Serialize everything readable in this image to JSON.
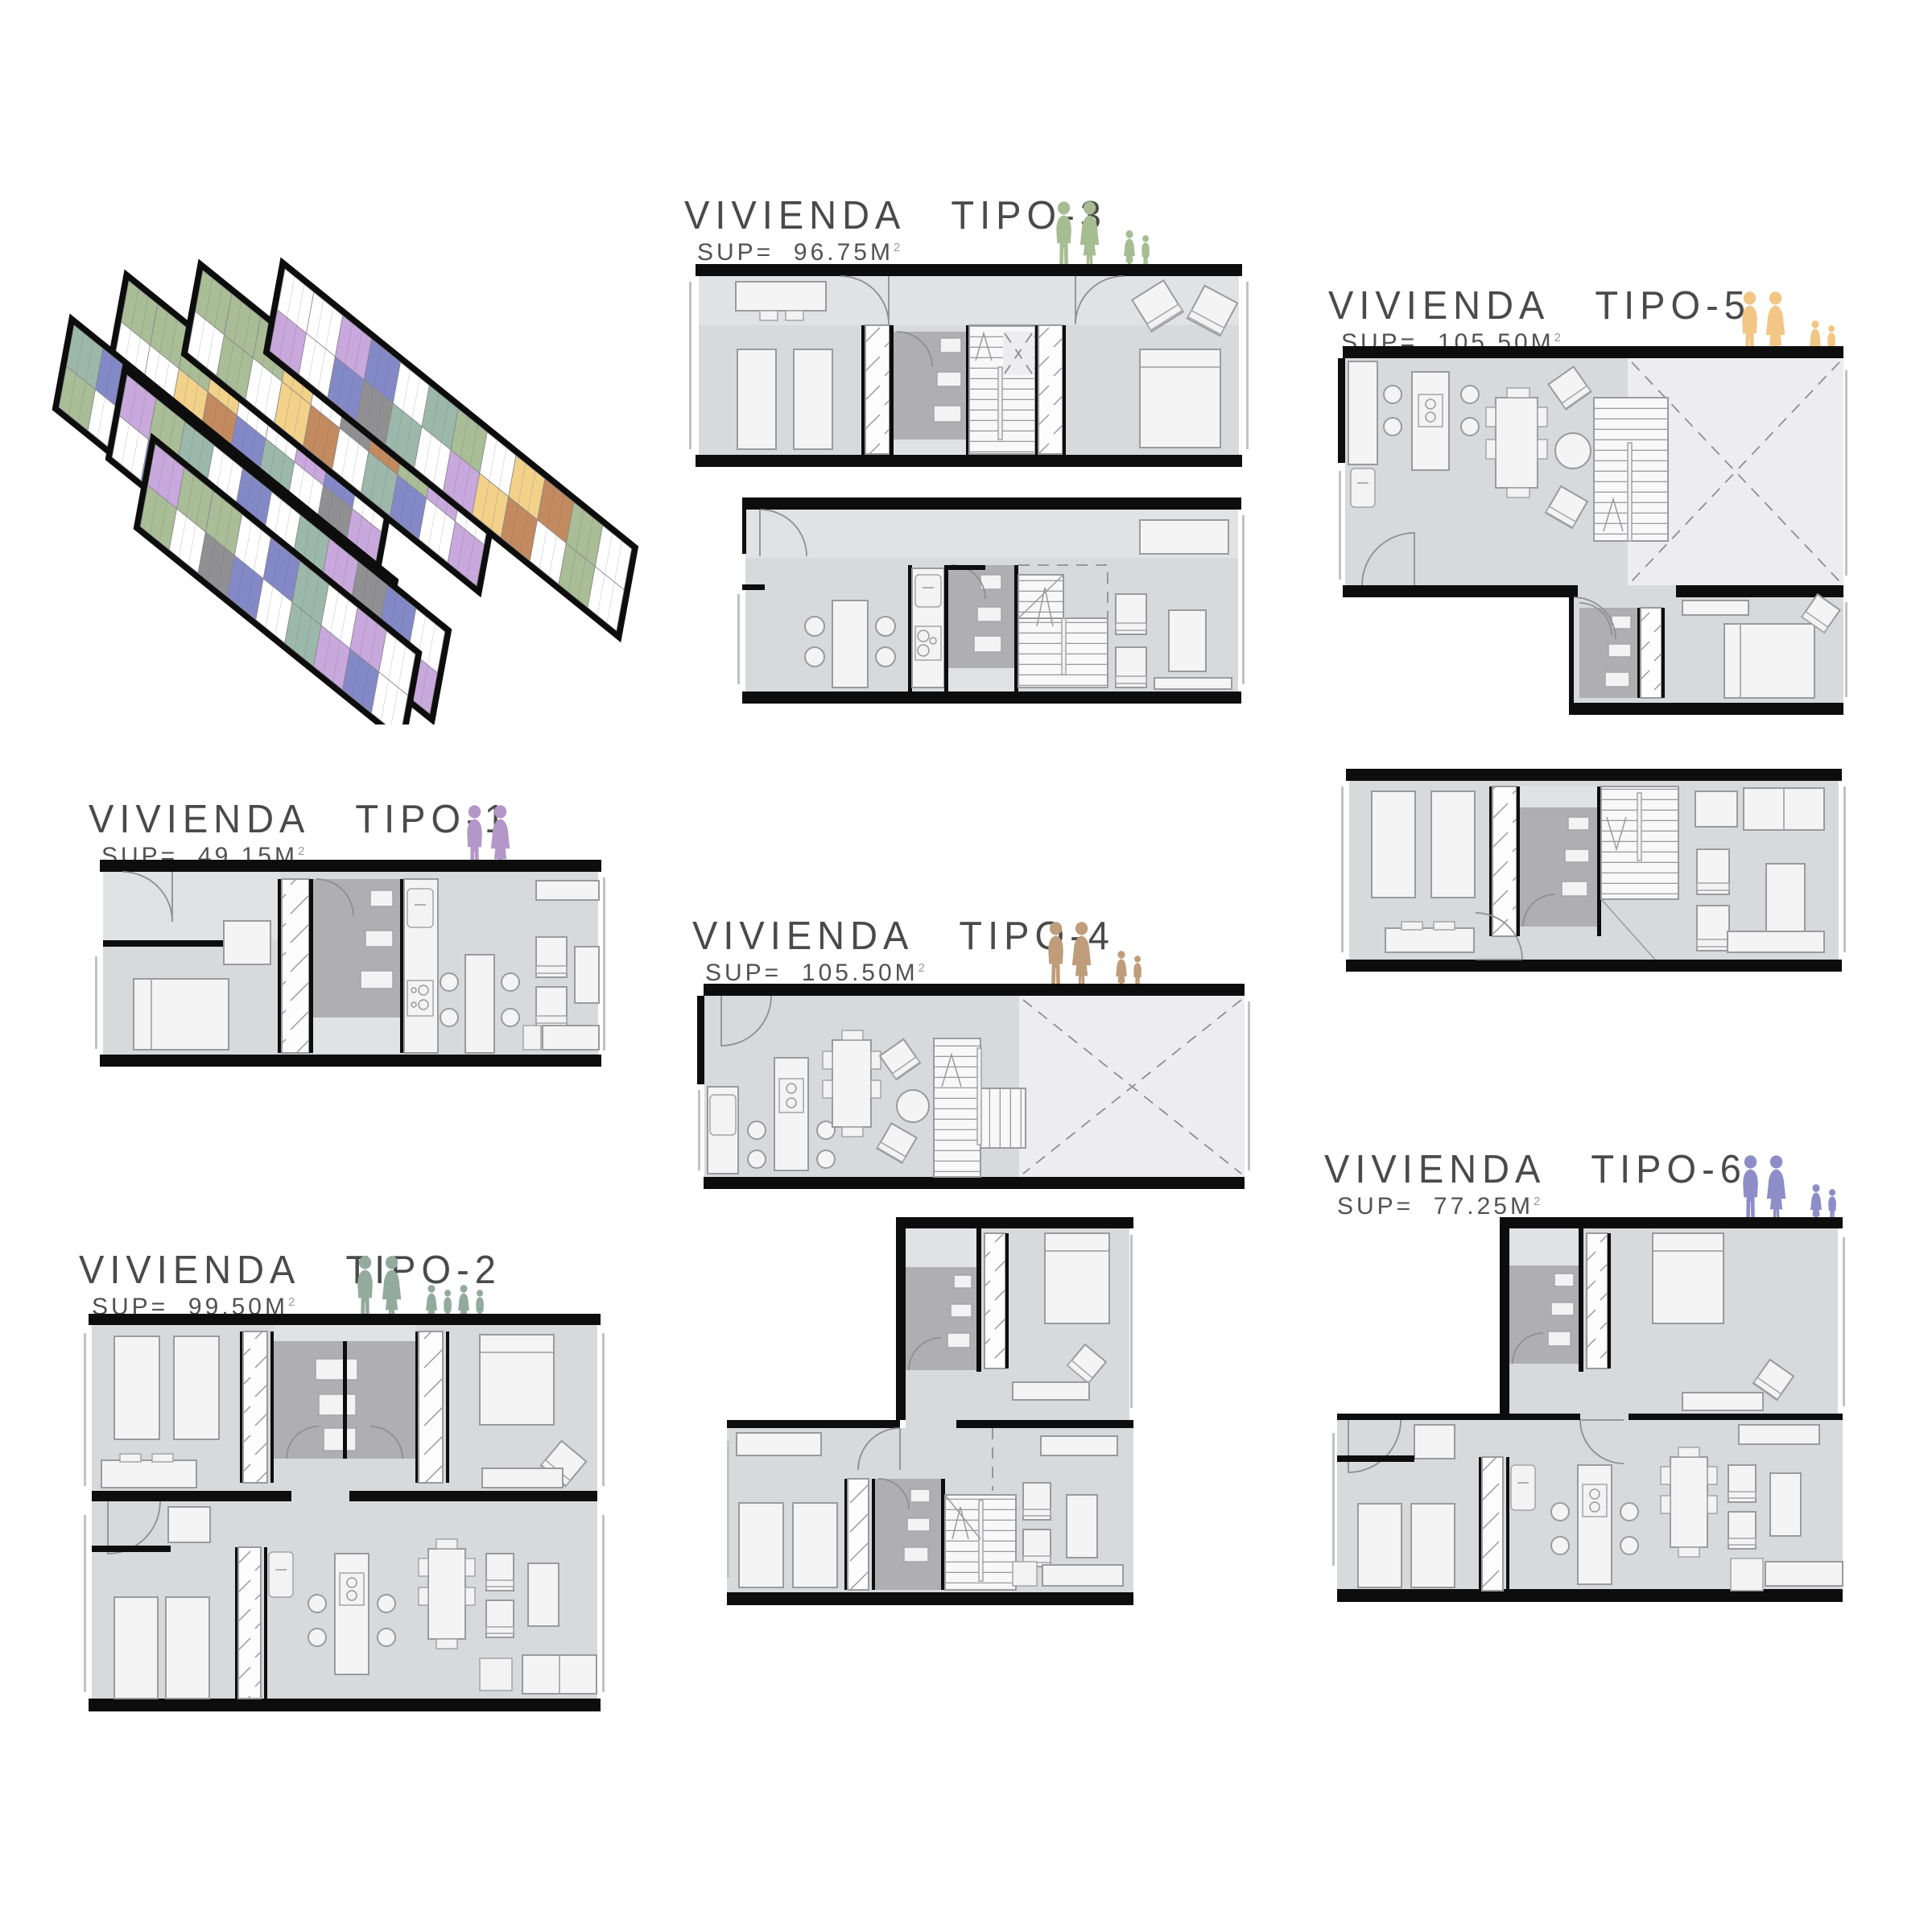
{
  "sheet_title": "vivienda typologies sheet",
  "plan_style": {
    "floor": "#d8d9db",
    "floor2": "#e1e2e4",
    "wall": "#0d0d0d",
    "core": "#afafb1",
    "voidc": "#ededef",
    "furn": "#f4f4f5"
  },
  "panels": {
    "tipo1": {
      "title": "VIVIENDA",
      "tipo": "TIPO-1",
      "sup_prefix": "SUP=",
      "area": "49.15M",
      "area_exponent": "2",
      "figure_color": "#b497c9",
      "adults": 2,
      "children": 0
    },
    "tipo2": {
      "title": "VIVIENDA",
      "tipo": "TIPO-2",
      "sup_prefix": "SUP=",
      "area": "99.50M",
      "area_exponent": "2",
      "figure_color": "#93ab9e",
      "adults": 2,
      "children": 4
    },
    "tipo3": {
      "title": "VIVIENDA",
      "tipo": "TIPO-3",
      "sup_prefix": "SUP=",
      "area": "96.75M",
      "area_exponent": "2",
      "figure_color": "#a6bd92",
      "adults": 2,
      "children": 2
    },
    "tipo4": {
      "title": "VIVIENDA",
      "tipo": "TIPO-4",
      "sup_prefix": "SUP=",
      "area": "105.50M",
      "area_exponent": "2",
      "figure_color": "#bf9c7a",
      "adults": 2,
      "children": 2
    },
    "tipo5": {
      "title": "VIVIENDA",
      "tipo": "TIPO-5",
      "sup_prefix": "SUP=",
      "area": "105.50M",
      "area_exponent": "2",
      "figure_color": "#f2c684",
      "adults": 2,
      "children": 2
    },
    "tipo6": {
      "title": "VIVIENDA",
      "tipo": "TIPO-6",
      "sup_prefix": "SUP=",
      "area": "77.25M",
      "area_exponent": "2",
      "figure_color": "#8d8ec7",
      "adults": 2,
      "children": 2
    }
  },
  "axon": {
    "palette": {
      "g": "#a9bd96",
      "y": "#f2d189",
      "o": "#c28a5e",
      "p": "#c9a8dd",
      "b": "#8388c6",
      "t": "#9cb8ab",
      "k": "#909092",
      "w": "#ffffff"
    },
    "strips": [
      {
        "top": [
          "g",
          "g",
          "g",
          "y",
          "w",
          "w",
          "p",
          "b",
          "w"
        ],
        "bottom": [
          "w",
          "w",
          "y",
          "o",
          "b",
          "t",
          "w",
          "k",
          "p"
        ]
      },
      {
        "top": [
          "g",
          "g",
          "g",
          "y",
          "w",
          "k",
          "o",
          "g",
          "p",
          "w"
        ],
        "bottom": [
          "w",
          "g",
          "w",
          "y",
          "o",
          "w",
          "t",
          "b",
          "w",
          "p"
        ]
      },
      {
        "top": [
          "w",
          "w",
          "p",
          "b",
          "w",
          "t",
          "g",
          "w",
          "y",
          "o",
          "g",
          "w"
        ],
        "bottom": [
          "p",
          "w",
          "b",
          "k",
          "t",
          "w",
          "p",
          "y",
          "o",
          "w",
          "g",
          "w"
        ]
      },
      {
        "top": [
          "t",
          "b",
          "w",
          "p",
          "k",
          "t",
          "w",
          "b",
          "g",
          "y",
          "w"
        ],
        "bottom": [
          "g",
          "w",
          "t",
          "p",
          "w",
          "b",
          "t",
          "w",
          "y",
          "o",
          "g"
        ]
      },
      {
        "top": [
          "p",
          "g",
          "t",
          "w",
          "b",
          "w",
          "t",
          "p",
          "k",
          "b",
          "w"
        ],
        "bottom": [
          "w",
          "b",
          "k",
          "w",
          "t",
          "p",
          "w",
          "b",
          "t",
          "w",
          "p"
        ]
      },
      {
        "top": [
          "p",
          "g",
          "g",
          "w",
          "b",
          "t",
          "w",
          "p",
          "w"
        ],
        "bottom": [
          "g",
          "w",
          "k",
          "b",
          "w",
          "t",
          "p",
          "b",
          "w"
        ]
      }
    ]
  }
}
